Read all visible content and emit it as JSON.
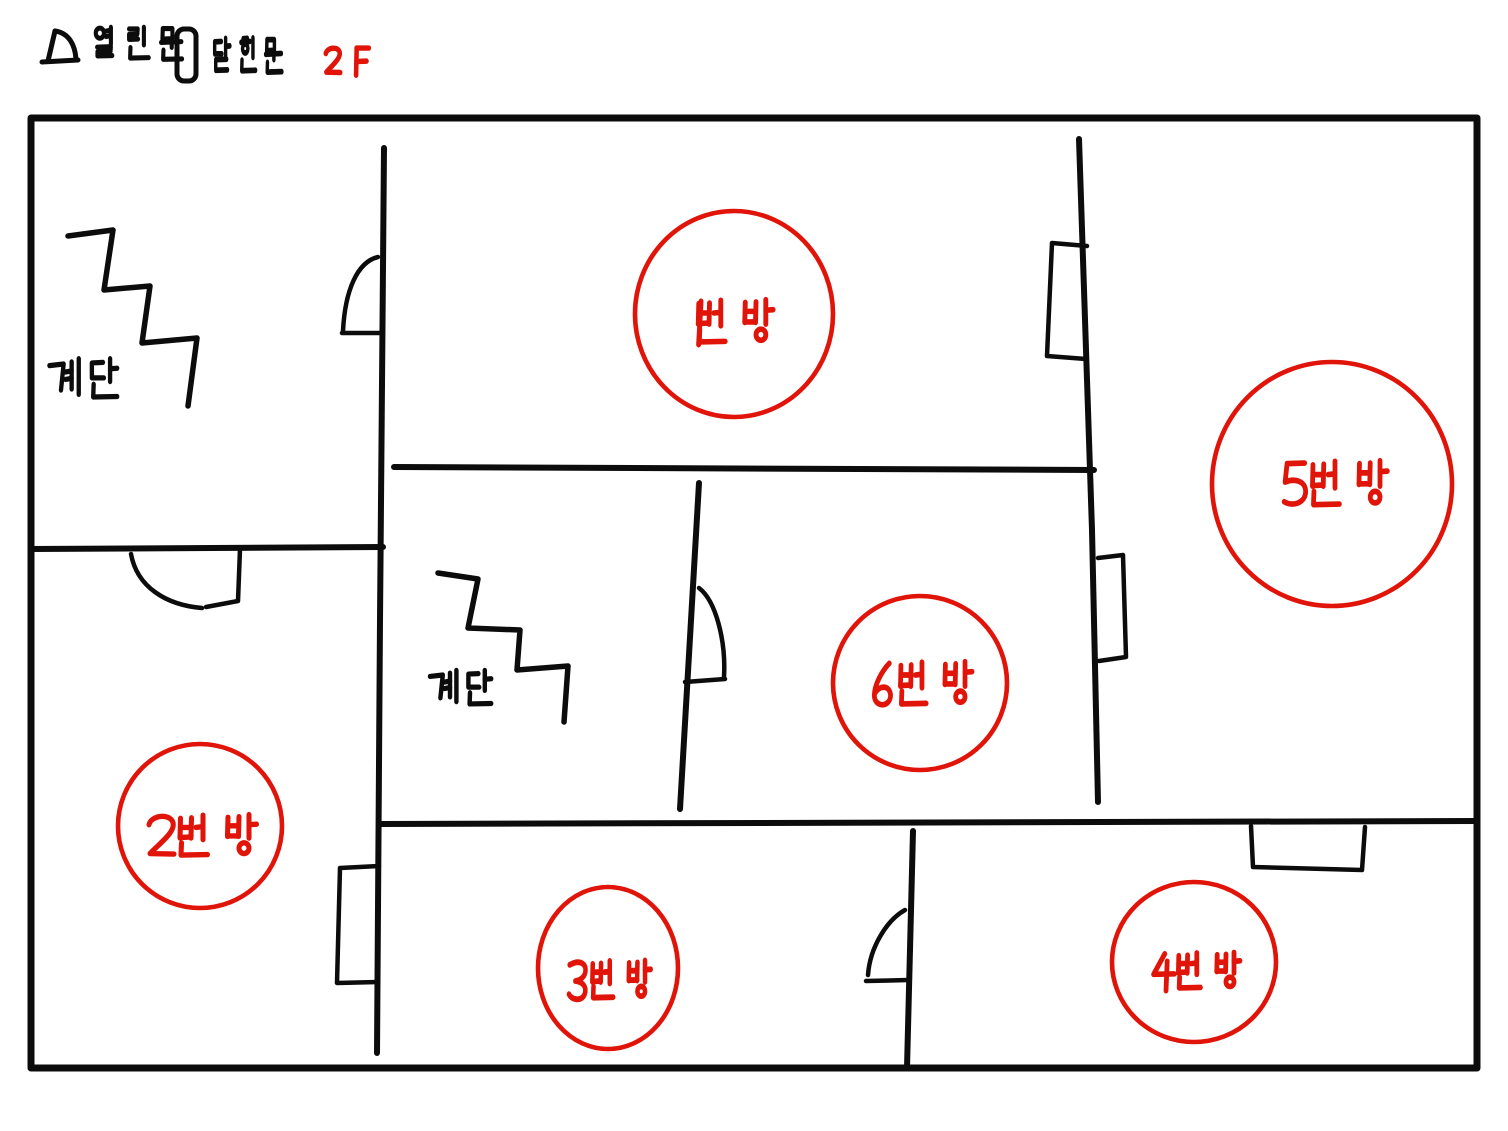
{
  "page": {
    "width": 1508,
    "height": 1131,
    "background": "#ffffff"
  },
  "colors": {
    "ink": "#0c0c0c",
    "red": "#e01408"
  },
  "legend": {
    "open_door": {
      "label": "열린문",
      "icon": "open-door-icon",
      "icon_paths": [
        "M55,31 C69,33 75,45 76,59",
        "M55,31 L48,61",
        "M42,62 L78,60"
      ],
      "label_pos": {
        "x": 93,
        "y": 26,
        "gw": 31,
        "gh": 38
      }
    },
    "closed_door": {
      "label": "닫힌문",
      "icon": "closed-door-icon",
      "icon_rect": {
        "x": 177,
        "y": 29,
        "w": 19,
        "h": 52,
        "r": 7
      },
      "label_pos": {
        "x": 212,
        "y": 37,
        "gw": 24,
        "gh": 40
      }
    },
    "floor": {
      "label": "2F",
      "pos": {
        "x": 320,
        "y": 46,
        "gw": 26,
        "gh": 31,
        "mono": true
      }
    }
  },
  "outline": {
    "x": 31,
    "y": 118,
    "w": 1446,
    "h": 950
  },
  "walls": [
    {
      "name": "wall-stairs-room-bottom",
      "d": "M31,549 L383,547"
    },
    {
      "name": "wall-main-vertical",
      "d": "M384,148 L380,620 L377,1053"
    },
    {
      "name": "wall-hallway-top",
      "d": "M394,467 L1094,470"
    },
    {
      "name": "wall-hall-mid-slant",
      "d": "M699,483 L680,809"
    },
    {
      "name": "wall-lower-corridor",
      "d": "M382,824 L1476,821"
    },
    {
      "name": "wall-room34-divider",
      "d": "M913,831 L907,1068"
    },
    {
      "name": "wall-right-section-slant",
      "d": "M1079,139 L1092,530 L1098,802"
    }
  ],
  "doors": [
    {
      "kind": "open",
      "name": "door-room1-to-stairs",
      "arc": "M378,257 C357,262 345,291 343,331",
      "leaf": "M342,333 L381,333"
    },
    {
      "kind": "open",
      "name": "door-room2-top",
      "arc": "M131,554 C137,587 166,605 202,608",
      "leaf": "M240,549 L238,601 L206,607"
    },
    {
      "kind": "open",
      "name": "door-hallway-mid",
      "arc": "M699,588 C716,601 726,641 724,677",
      "leaf": "M685,682 L725,679"
    },
    {
      "kind": "open",
      "name": "door-room3-room4",
      "arc": "M905,910 C887,920 870,947 868,975",
      "leaf": "M866,981 L909,980"
    },
    {
      "kind": "closed",
      "name": "door-room2-closed",
      "path": "M379,866 L340,868 L337,983 L378,982"
    },
    {
      "kind": "closed",
      "name": "door-room5-upper-closed",
      "path": "M1087,246 L1052,243 L1047,356 L1086,359"
    },
    {
      "kind": "closed",
      "name": "door-room5-lower-closed",
      "path": "M1098,558 L1123,555 L1126,657 L1099,661"
    },
    {
      "kind": "closed",
      "name": "door-room4-top-closed",
      "path": "M1251,826 L1253,867 L1362,870 L1365,827"
    }
  ],
  "stairs": [
    {
      "name": "stairs-upper-left",
      "label": "계단",
      "path": "M68,236 L113,230 L104,290 L150,286 L142,343 L197,338 L188,406",
      "label_pos": {
        "x": 45,
        "y": 356,
        "gw": 40,
        "gh": 48
      }
    },
    {
      "name": "stairs-middle",
      "label": "계단",
      "path": "M438,573 L478,579 L468,628 L520,630 L517,670 L568,666 L564,722",
      "label_pos": {
        "x": 426,
        "y": 668,
        "gw": 36,
        "gh": 42
      }
    }
  ],
  "rooms": [
    {
      "id": "1",
      "label": "1번방",
      "cx": 734,
      "cy": 314,
      "rx": 99,
      "ry": 103,
      "label_pos": {
        "cx": 730,
        "cy": 323,
        "gw": 44,
        "gh": 50
      }
    },
    {
      "id": "2",
      "label": "2번방",
      "cx": 200,
      "cy": 826,
      "rx": 82,
      "ry": 82,
      "label_pos": {
        "cx": 203,
        "cy": 837,
        "gw": 45,
        "gh": 48
      }
    },
    {
      "id": "3",
      "label": "3번방",
      "cx": 608,
      "cy": 968,
      "rx": 70,
      "ry": 81,
      "label_pos": {
        "cx": 610,
        "cy": 981,
        "gw": 34,
        "gh": 44
      }
    },
    {
      "id": "4",
      "label": "4번방",
      "cx": 1194,
      "cy": 962,
      "rx": 82,
      "ry": 80,
      "label_pos": {
        "cx": 1197,
        "cy": 972,
        "gw": 36,
        "gh": 42
      }
    },
    {
      "id": "5",
      "label": "5번방",
      "cx": 1332,
      "cy": 484,
      "rx": 120,
      "ry": 122,
      "label_pos": {
        "cx": 1335,
        "cy": 485,
        "gw": 44,
        "gh": 52
      }
    },
    {
      "id": "6",
      "label": "6번방",
      "cx": 920,
      "cy": 683,
      "rx": 87,
      "ry": 87,
      "label_pos": {
        "cx": 922,
        "cy": 685,
        "gw": 42,
        "gh": 50
      }
    }
  ]
}
